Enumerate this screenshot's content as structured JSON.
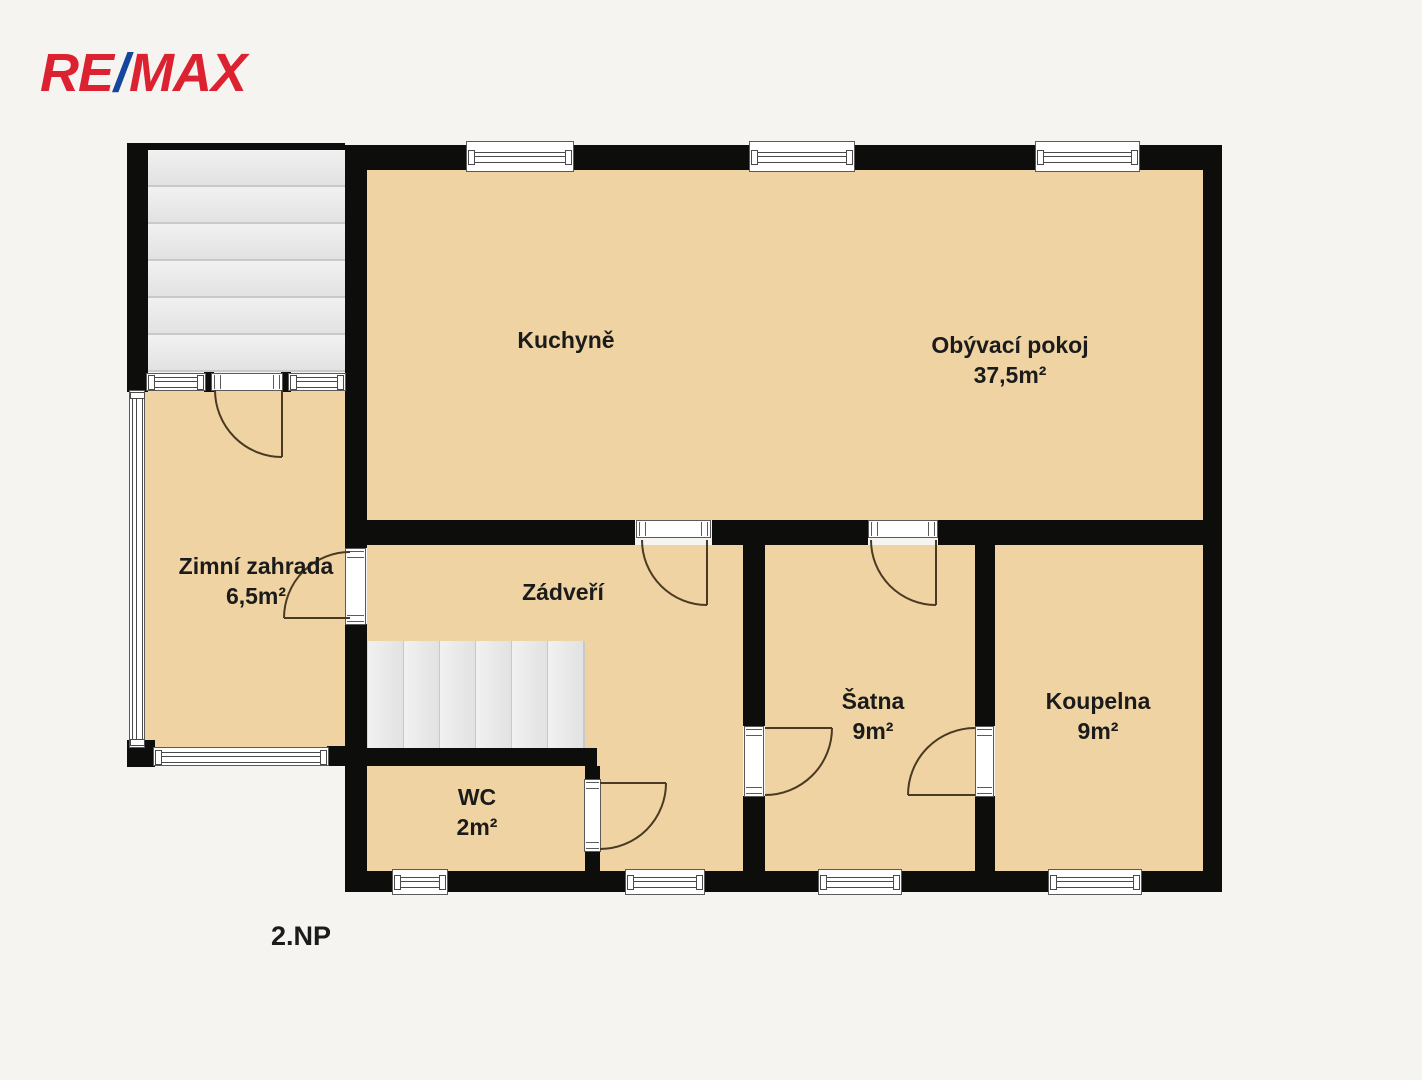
{
  "logo": {
    "re": "RE",
    "slash": "/",
    "max": "MAX"
  },
  "floor_label": "2.NP",
  "rooms": [
    {
      "id": "kuchyne",
      "name": "Kuchyně",
      "area": ""
    },
    {
      "id": "obyvaci-pokoj",
      "name": "Obývací pokoj",
      "area": "37,5m²"
    },
    {
      "id": "zimni-zahrada",
      "name": "Zimní zahrada",
      "area": "6,5m²"
    },
    {
      "id": "zadveri",
      "name": "Zádveří",
      "area": ""
    },
    {
      "id": "satna",
      "name": "Šatna",
      "area": "9m²"
    },
    {
      "id": "koupelna",
      "name": "Koupelna",
      "area": "9m²"
    },
    {
      "id": "wc",
      "name": "WC",
      "area": "2m²"
    }
  ],
  "colors": {
    "remax_red": "#dc2130",
    "remax_blue": "#16459d",
    "wall": "#0d0d0c",
    "floor": "#efd3a2",
    "background": "#f5f4f1",
    "stair_tread": "#ebebeb",
    "door_arc": "#4a3a24"
  }
}
